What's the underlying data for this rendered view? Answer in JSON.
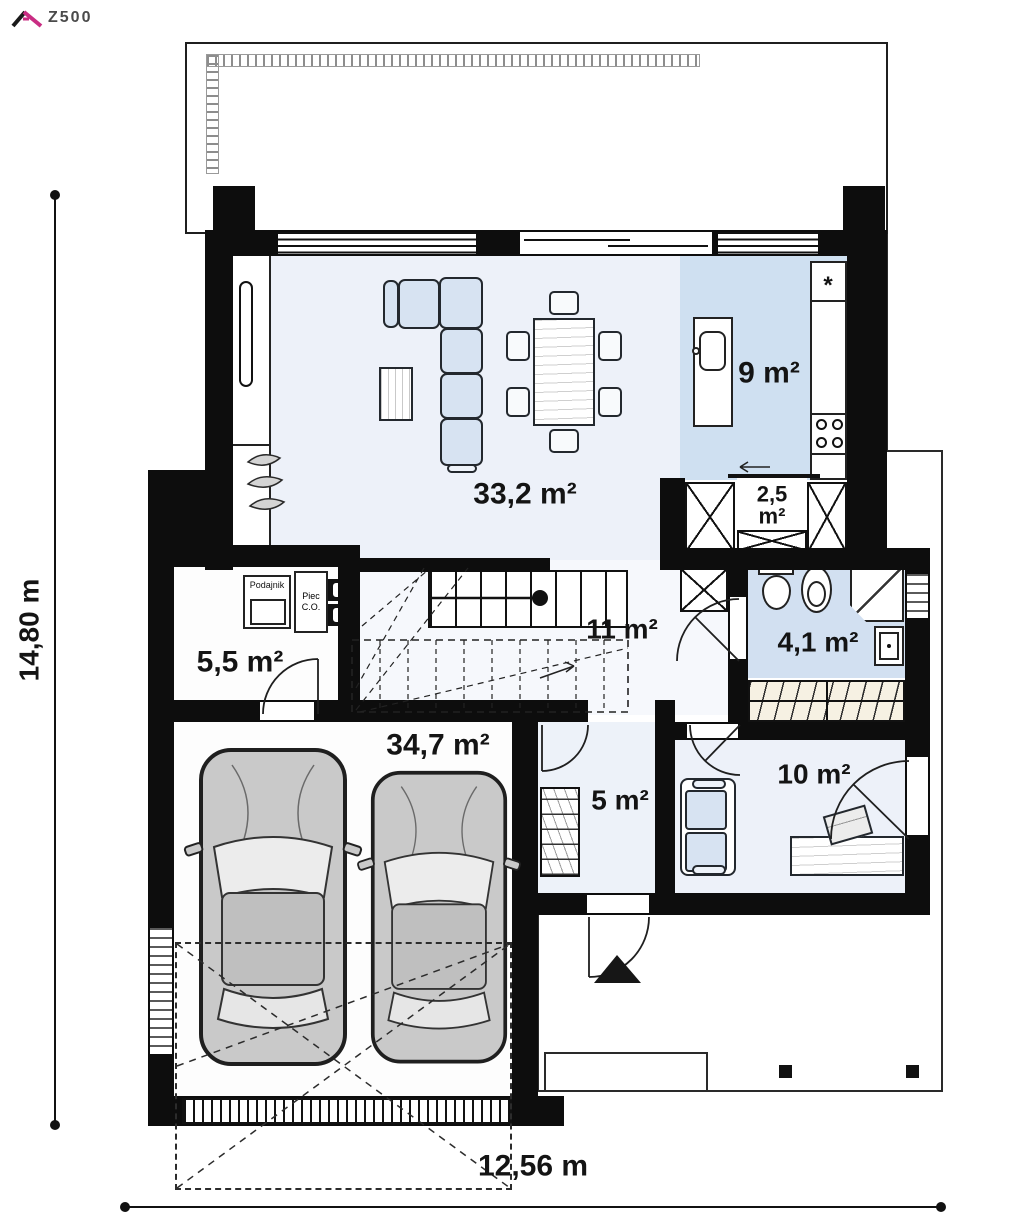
{
  "logo": {
    "brand": "Z500"
  },
  "dimensions": {
    "height": "14,80 m",
    "width": "12,56 m"
  },
  "rooms": {
    "living": {
      "area": "33,2 m²"
    },
    "kitchen": {
      "area": "9 m²"
    },
    "pantry": {
      "area": "2,5 m²"
    },
    "hall": {
      "area": "11 m²"
    },
    "bathroom": {
      "area": "4,1 m²"
    },
    "technical": {
      "area": "5,5 m²",
      "feeder_label": "Podajnik",
      "boiler_label": "Piec C.O."
    },
    "garage": {
      "area": "34,7 m²"
    },
    "entry": {
      "area": "5 m²"
    },
    "office": {
      "area": "10 m²"
    }
  },
  "symbols": {
    "fridge": "*"
  },
  "colors": {
    "wall": "#0d0d0d",
    "room_pale": "#edf1f9",
    "room_blue": "#cfe0f1",
    "furniture_blue": "#d7e3f2",
    "logo_pink": "#c92d83"
  }
}
